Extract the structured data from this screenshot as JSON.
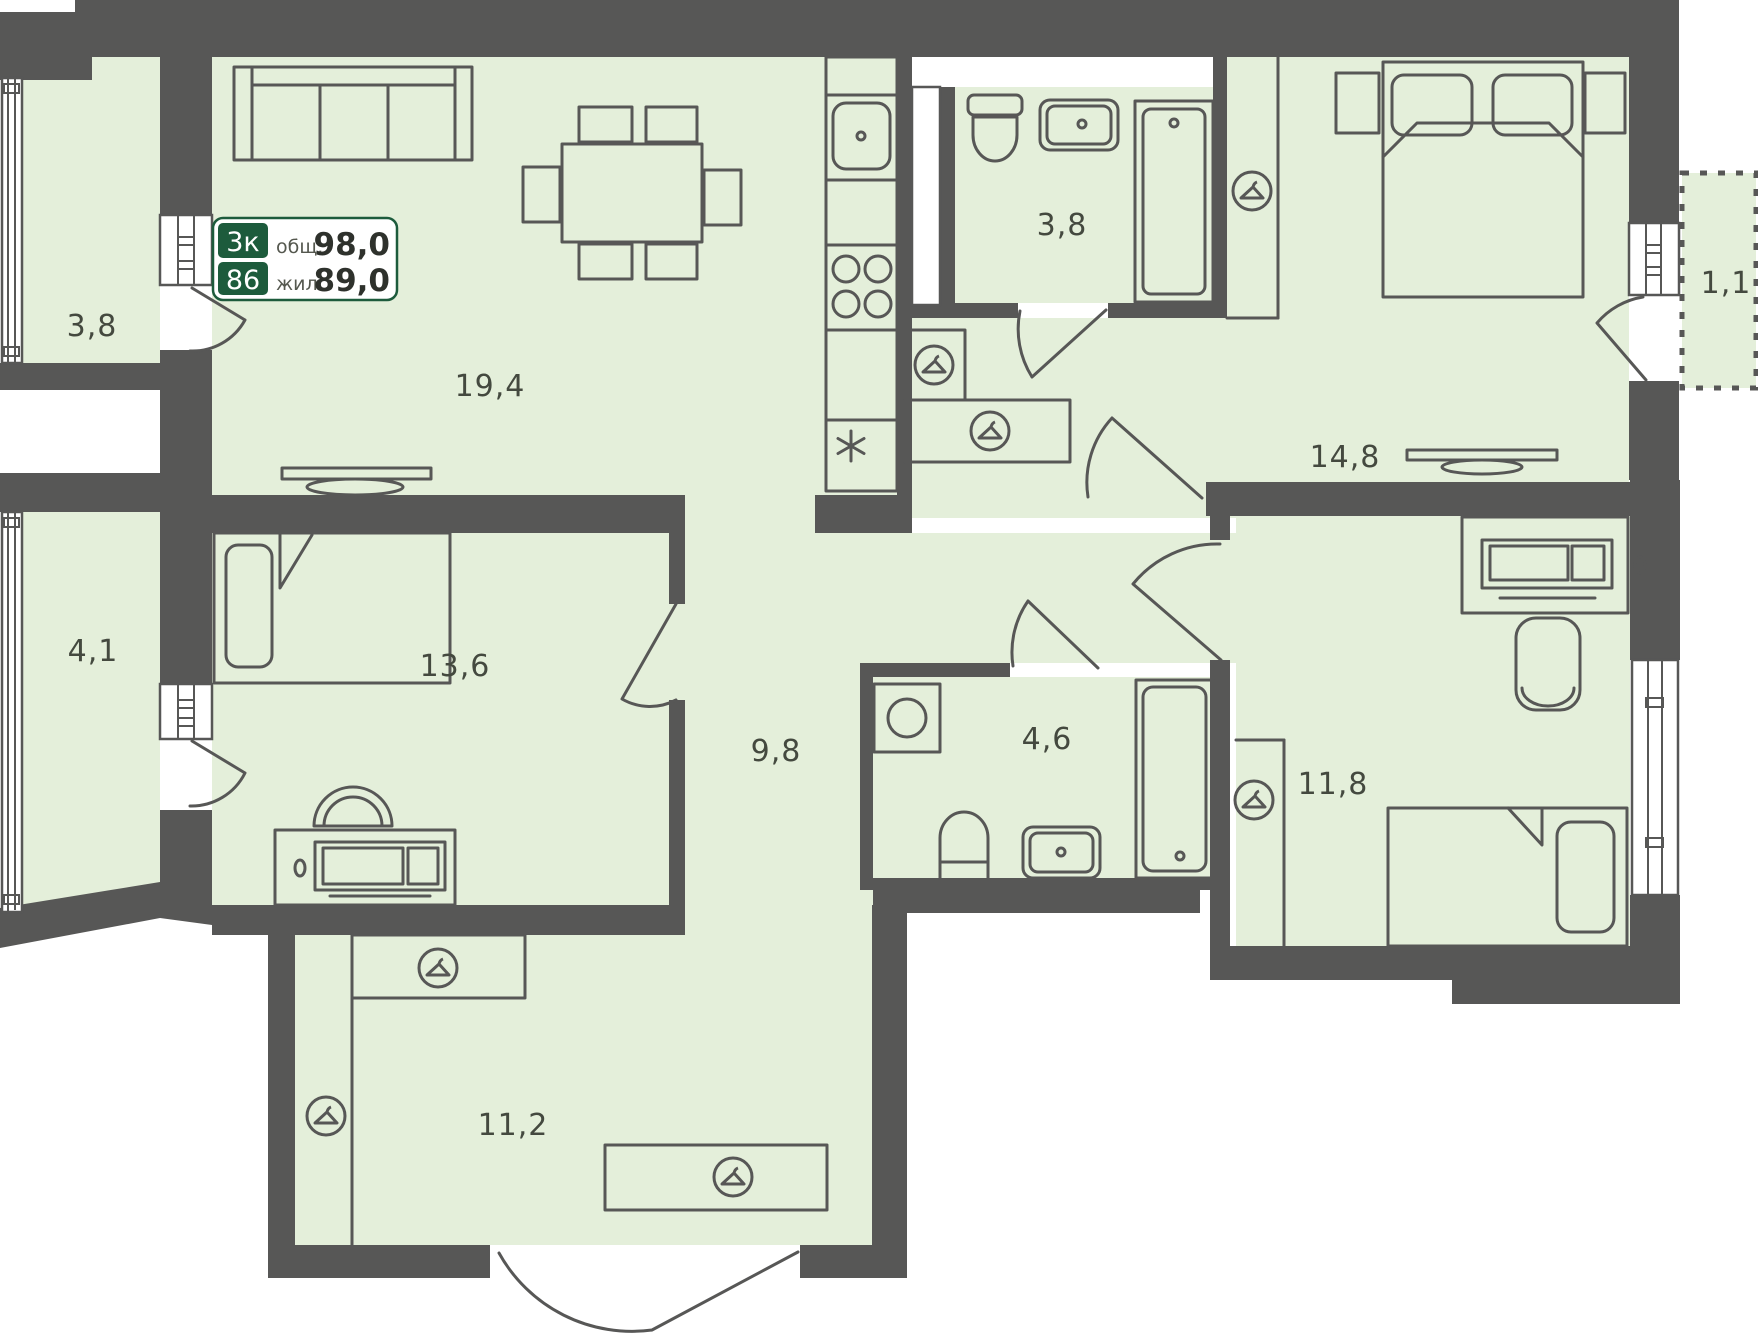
{
  "plan": {
    "badge": {
      "rooms_count": "3к",
      "apartment_number": "86",
      "total_label": "общ.",
      "total_value": "98,0",
      "living_label": "жил.",
      "living_value": "89,0"
    },
    "rooms": [
      {
        "name": "balcony-top-left",
        "area": "3,8"
      },
      {
        "name": "living-room-kitchen",
        "area": "19,4"
      },
      {
        "name": "bathroom-small",
        "area": "3,8"
      },
      {
        "name": "bedroom-master",
        "area": "14,8"
      },
      {
        "name": "loggia-right",
        "area": "1,1"
      },
      {
        "name": "balcony-bottom-left",
        "area": "4,1"
      },
      {
        "name": "bedroom-kids",
        "area": "13,6"
      },
      {
        "name": "hallway",
        "area": "9,8"
      },
      {
        "name": "bathroom-main",
        "area": "4,6"
      },
      {
        "name": "bedroom-second",
        "area": "11,8"
      },
      {
        "name": "corridor",
        "area": "11,2"
      }
    ],
    "icons": {
      "wardrobe": "hanger-icon",
      "kitchen_extra": "asterisk-icon"
    },
    "colors": {
      "wall": "#575756",
      "floor": "#e4efda",
      "accent_green": "#1d5b3c",
      "label_text": "#44493f",
      "background": "#ffffff"
    }
  }
}
